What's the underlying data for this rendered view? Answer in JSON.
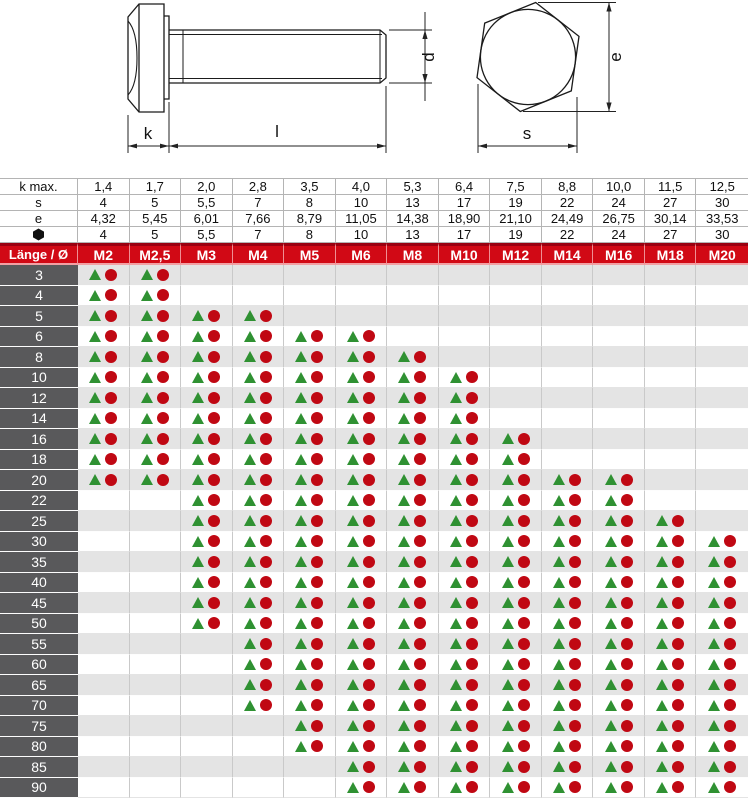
{
  "drawing": {
    "type": "hex-bolt-technical-drawing",
    "labels": {
      "head_height": "k",
      "length": "l",
      "diameter": "d",
      "across_corners": "e",
      "across_flats": "s"
    }
  },
  "colors": {
    "header_red": "#d10915",
    "header_red_dark": "#9b0010",
    "header_red_light": "#f2a0a4",
    "row_label_gray": "#59595b",
    "stripe_gray": "#e4e4e4",
    "triangle_green": "#2f9132",
    "circle_red": "#c00813",
    "line_black": "#1b1b1b"
  },
  "table": {
    "corner_label": "Länge / Ø",
    "sizes": [
      "M2",
      "M2,5",
      "M3",
      "M4",
      "M5",
      "M6",
      "M8",
      "M10",
      "M12",
      "M14",
      "M16",
      "M18",
      "M20"
    ],
    "spec_rows": [
      {
        "label": "k max.",
        "values": [
          "1,4",
          "1,7",
          "2,0",
          "2,8",
          "3,5",
          "4,0",
          "5,3",
          "6,4",
          "7,5",
          "8,8",
          "10,0",
          "11,5",
          "12,5"
        ]
      },
      {
        "label": "s",
        "values": [
          "4",
          "5",
          "5,5",
          "7",
          "8",
          "10",
          "13",
          "17",
          "19",
          "22",
          "24",
          "27",
          "30"
        ]
      },
      {
        "label": "e",
        "values": [
          "4,32",
          "5,45",
          "6,01",
          "7,66",
          "8,79",
          "11,05",
          "14,38",
          "18,90",
          "21,10",
          "24,49",
          "26,75",
          "30,14",
          "33,53"
        ]
      },
      {
        "label": "",
        "icon": "hex-bullet-icon",
        "values": [
          "4",
          "5",
          "5,5",
          "7",
          "8",
          "10",
          "13",
          "17",
          "19",
          "22",
          "24",
          "27",
          "30"
        ]
      }
    ],
    "rows": [
      {
        "length": "3",
        "available": [
          1,
          1,
          0,
          0,
          0,
          0,
          0,
          0,
          0,
          0,
          0,
          0,
          0
        ]
      },
      {
        "length": "4",
        "available": [
          1,
          1,
          0,
          0,
          0,
          0,
          0,
          0,
          0,
          0,
          0,
          0,
          0
        ]
      },
      {
        "length": "5",
        "available": [
          1,
          1,
          1,
          1,
          0,
          0,
          0,
          0,
          0,
          0,
          0,
          0,
          0
        ]
      },
      {
        "length": "6",
        "available": [
          1,
          1,
          1,
          1,
          1,
          1,
          0,
          0,
          0,
          0,
          0,
          0,
          0
        ]
      },
      {
        "length": "8",
        "available": [
          1,
          1,
          1,
          1,
          1,
          1,
          1,
          0,
          0,
          0,
          0,
          0,
          0
        ]
      },
      {
        "length": "10",
        "available": [
          1,
          1,
          1,
          1,
          1,
          1,
          1,
          1,
          0,
          0,
          0,
          0,
          0
        ]
      },
      {
        "length": "12",
        "available": [
          1,
          1,
          1,
          1,
          1,
          1,
          1,
          1,
          0,
          0,
          0,
          0,
          0
        ]
      },
      {
        "length": "14",
        "available": [
          1,
          1,
          1,
          1,
          1,
          1,
          1,
          1,
          0,
          0,
          0,
          0,
          0
        ]
      },
      {
        "length": "16",
        "available": [
          1,
          1,
          1,
          1,
          1,
          1,
          1,
          1,
          1,
          0,
          0,
          0,
          0
        ]
      },
      {
        "length": "18",
        "available": [
          1,
          1,
          1,
          1,
          1,
          1,
          1,
          1,
          1,
          0,
          0,
          0,
          0
        ]
      },
      {
        "length": "20",
        "available": [
          1,
          1,
          1,
          1,
          1,
          1,
          1,
          1,
          1,
          1,
          1,
          0,
          0
        ]
      },
      {
        "length": "22",
        "available": [
          0,
          0,
          1,
          1,
          1,
          1,
          1,
          1,
          1,
          1,
          1,
          0,
          0
        ]
      },
      {
        "length": "25",
        "available": [
          0,
          0,
          1,
          1,
          1,
          1,
          1,
          1,
          1,
          1,
          1,
          1,
          0
        ]
      },
      {
        "length": "30",
        "available": [
          0,
          0,
          1,
          1,
          1,
          1,
          1,
          1,
          1,
          1,
          1,
          1,
          1
        ]
      },
      {
        "length": "35",
        "available": [
          0,
          0,
          1,
          1,
          1,
          1,
          1,
          1,
          1,
          1,
          1,
          1,
          1
        ]
      },
      {
        "length": "40",
        "available": [
          0,
          0,
          1,
          1,
          1,
          1,
          1,
          1,
          1,
          1,
          1,
          1,
          1
        ]
      },
      {
        "length": "45",
        "available": [
          0,
          0,
          1,
          1,
          1,
          1,
          1,
          1,
          1,
          1,
          1,
          1,
          1
        ]
      },
      {
        "length": "50",
        "available": [
          0,
          0,
          1,
          1,
          1,
          1,
          1,
          1,
          1,
          1,
          1,
          1,
          1
        ]
      },
      {
        "length": "55",
        "available": [
          0,
          0,
          0,
          1,
          1,
          1,
          1,
          1,
          1,
          1,
          1,
          1,
          1
        ]
      },
      {
        "length": "60",
        "available": [
          0,
          0,
          0,
          1,
          1,
          1,
          1,
          1,
          1,
          1,
          1,
          1,
          1
        ]
      },
      {
        "length": "65",
        "available": [
          0,
          0,
          0,
          1,
          1,
          1,
          1,
          1,
          1,
          1,
          1,
          1,
          1
        ]
      },
      {
        "length": "70",
        "available": [
          0,
          0,
          0,
          1,
          1,
          1,
          1,
          1,
          1,
          1,
          1,
          1,
          1
        ]
      },
      {
        "length": "75",
        "available": [
          0,
          0,
          0,
          0,
          1,
          1,
          1,
          1,
          1,
          1,
          1,
          1,
          1
        ]
      },
      {
        "length": "80",
        "available": [
          0,
          0,
          0,
          0,
          1,
          1,
          1,
          1,
          1,
          1,
          1,
          1,
          1
        ]
      },
      {
        "length": "85",
        "available": [
          0,
          0,
          0,
          0,
          0,
          1,
          1,
          1,
          1,
          1,
          1,
          1,
          1
        ]
      },
      {
        "length": "90",
        "available": [
          0,
          0,
          0,
          0,
          0,
          1,
          1,
          1,
          1,
          1,
          1,
          1,
          1
        ]
      }
    ]
  }
}
